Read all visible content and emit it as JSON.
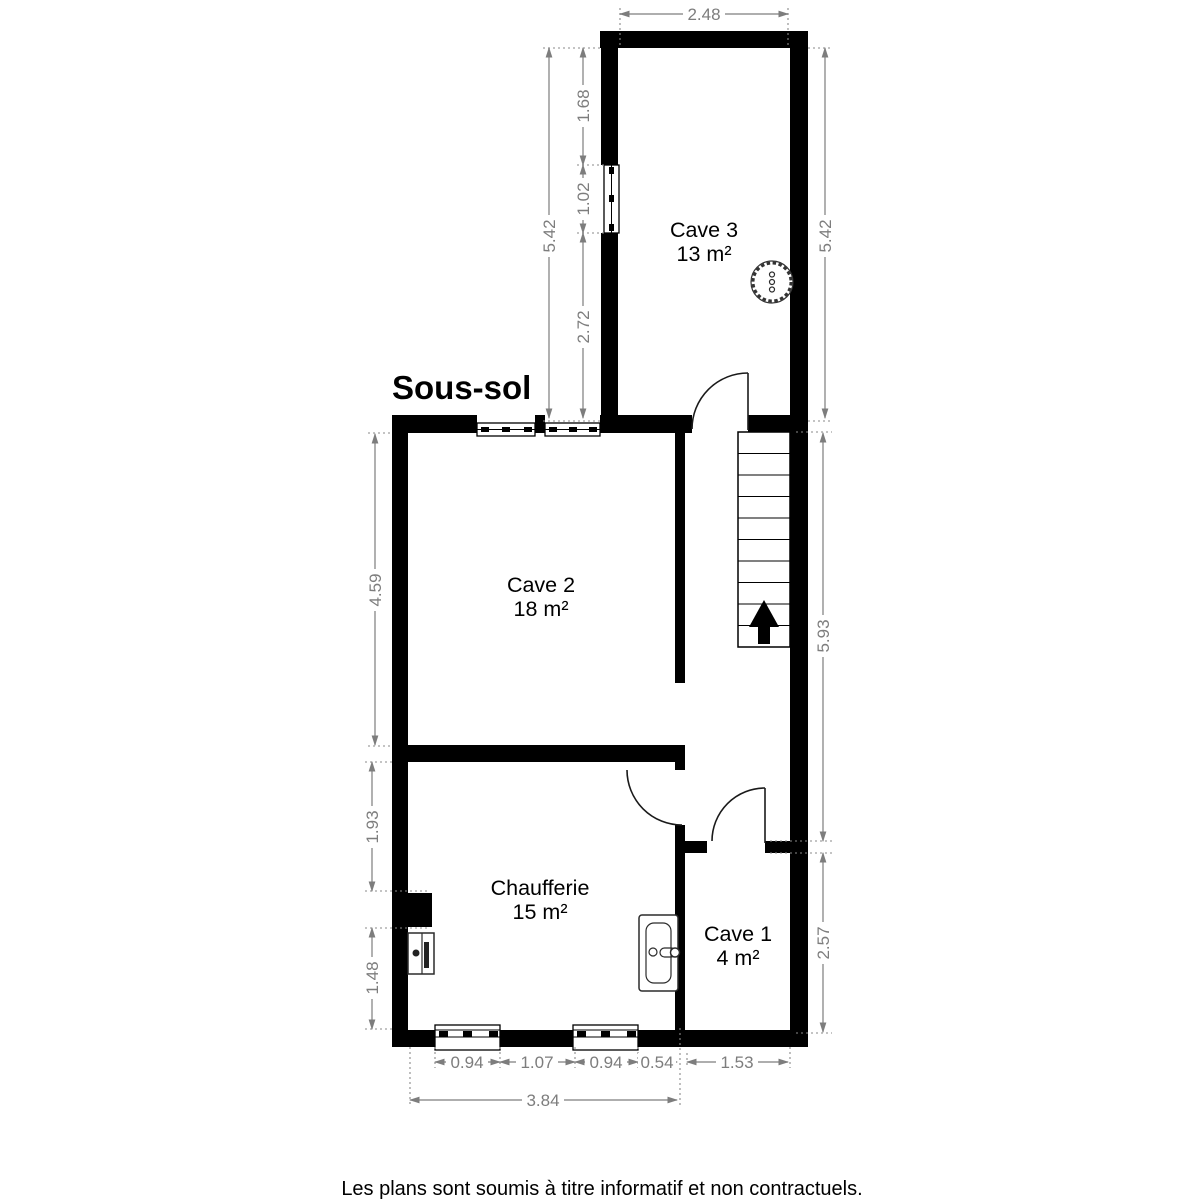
{
  "title": "Sous-sol",
  "disclaimer": "Les plans sont soumis à titre informatif et non contractuels.",
  "rooms": [
    {
      "id": "cave-3",
      "name": "Cave 3",
      "area": "13 m²"
    },
    {
      "id": "cave-2",
      "name": "Cave 2",
      "area": "18 m²"
    },
    {
      "id": "chaufferie",
      "name": "Chaufferie",
      "area": "15 m²"
    },
    {
      "id": "cave-1",
      "name": "Cave 1",
      "area": "4 m²"
    }
  ],
  "dimensions": {
    "cave3_width_top": "2.48",
    "left_total_upper": "5.42",
    "left_wall_to_window": "1.68",
    "left_window_width": "1.02",
    "left_window_to_corner": "2.72",
    "right_total_upper": "5.42",
    "cave2_height": "4.59",
    "right_hall_height": "5.93",
    "chaufferie_upper": "1.93",
    "chaufferie_lower": "1.48",
    "cave1_height": "2.57",
    "bottom_window1": "0.94",
    "bottom_between_windows": "1.07",
    "bottom_window2": "0.94",
    "bottom_right": "0.54",
    "cave1_width": "1.53",
    "bottom_total": "3.84"
  },
  "colors": {
    "wall": "#000000",
    "dimension": "#7d7d7d",
    "text": "#000000",
    "background": "#ffffff"
  }
}
